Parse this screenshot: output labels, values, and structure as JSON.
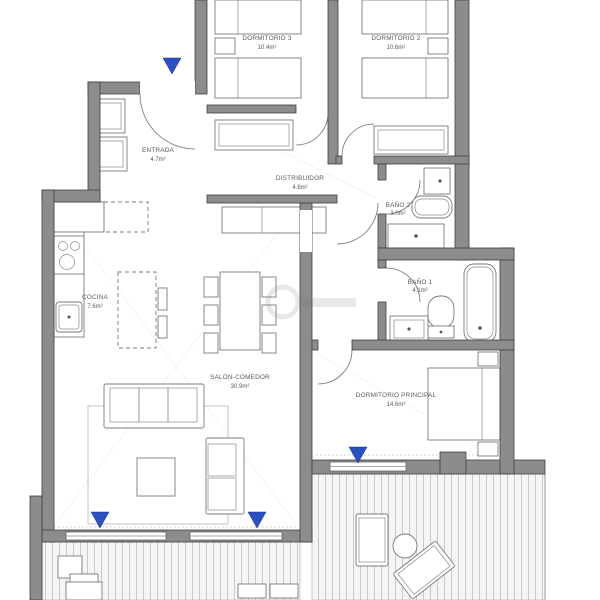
{
  "colors": {
    "wall": "#8c8c8c",
    "wall_outline": "#3f3f3f",
    "marker": "#2a50c4",
    "label": "#5a5a5a",
    "deck_stripe": "#c9c9c9"
  },
  "rooms": {
    "dormitorio_3": {
      "name": "DORMITORIO 3",
      "area": "10.4m²"
    },
    "dormitorio_2": {
      "name": "DORMITORIO 2",
      "area": "10.6m²"
    },
    "entrada": {
      "name": "ENTRADA",
      "area": "4.7m²"
    },
    "distribuidor": {
      "name": "DISTRIBUIDOR",
      "area": "4.6m²"
    },
    "bano_2": {
      "name": "BAÑO 2",
      "area": "3.0m²"
    },
    "bano_1": {
      "name": "BAÑO 1",
      "area": "4.1m²"
    },
    "cocina": {
      "name": "COCINA",
      "area": "7.6m²"
    },
    "salon_comedor": {
      "name": "SALON-COMEDOR",
      "area": "30.9m²"
    },
    "dormitorio_principal": {
      "name": "DORMITORIO PRINCIPAL",
      "area": "14.6m²"
    }
  }
}
